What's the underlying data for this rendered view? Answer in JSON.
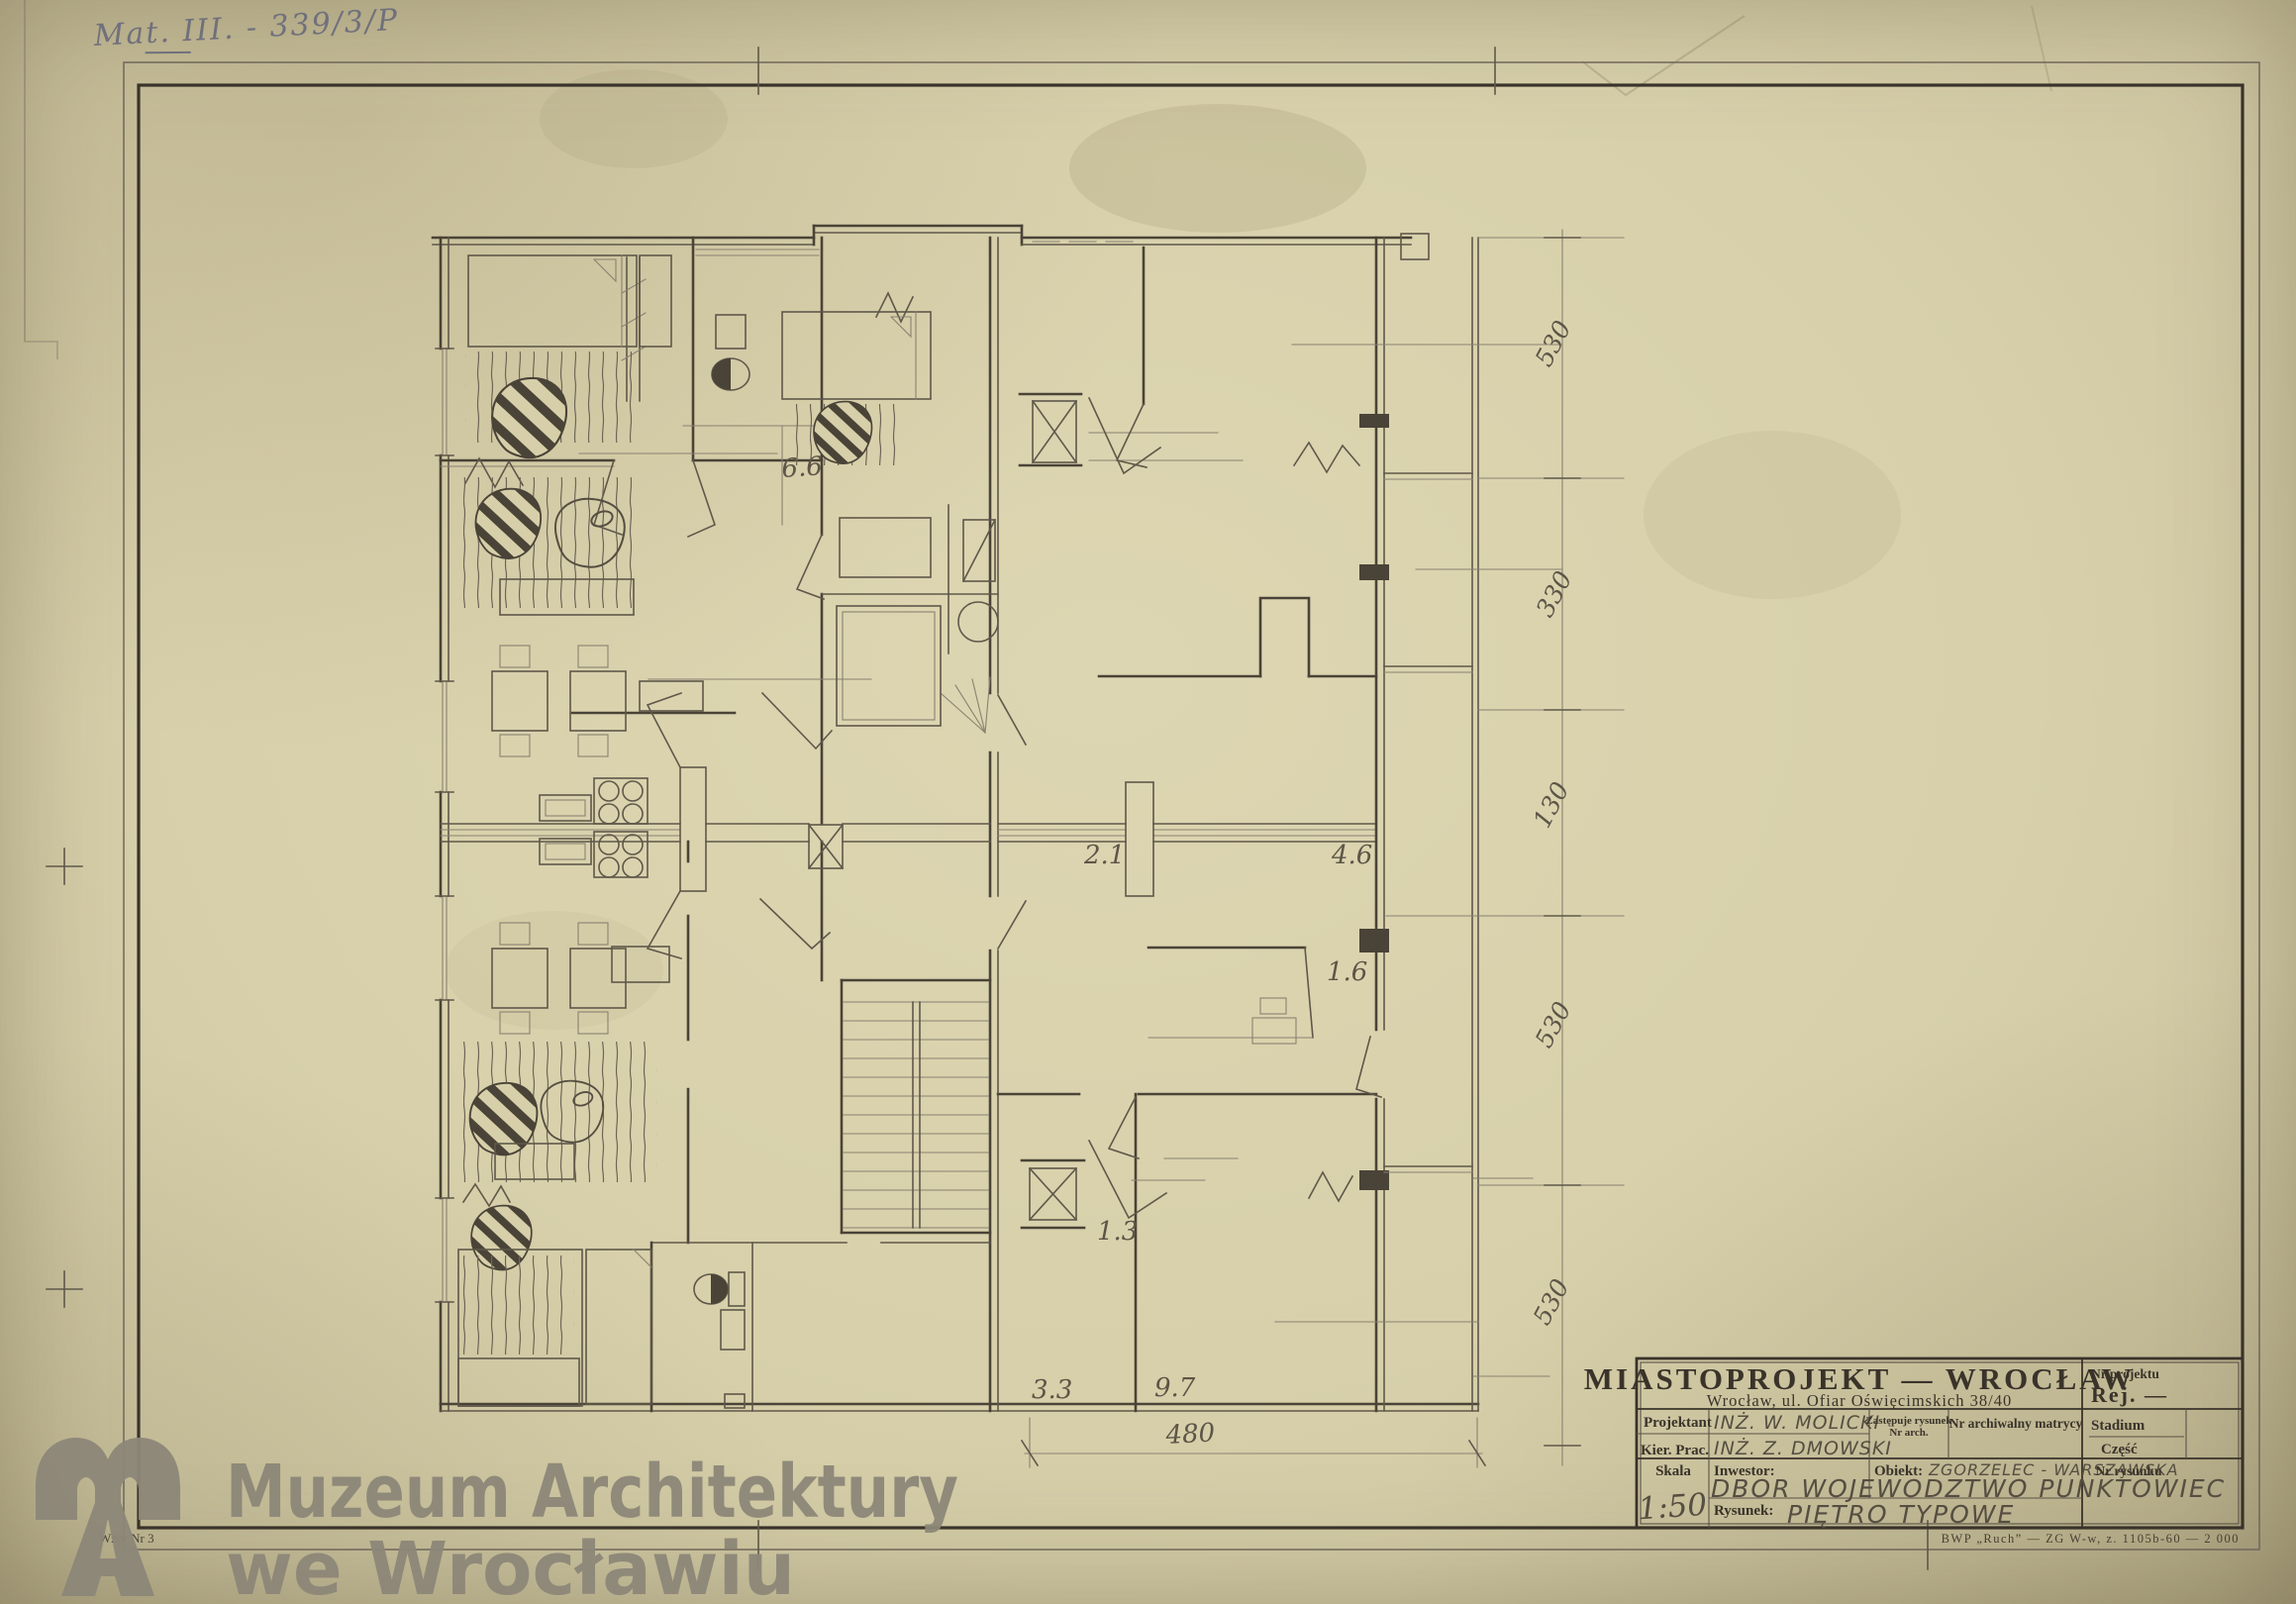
{
  "colors": {
    "paper": "#d7d0aa",
    "pencil": "#5f584a",
    "heavy_line": "#3a332a",
    "watermark_gray": "#8d8779",
    "annotation_pencil": "#70707c"
  },
  "archive_annotation": "Mat. III. - 339/3/P",
  "form_note": "Wzór Nr 3",
  "print_credit": "BWP „Ruch” — ZG W-w, z. 1105b-60 — 2 000",
  "watermark": {
    "logo": "MA monogram",
    "line1": "Muzeum Architektury",
    "line2": "we Wrocławiu"
  },
  "title_block": {
    "company": "MIASTOPROJEKT — WROCŁAW",
    "address": "Wrocław, ul. Ofiar Oświęcimskich 38/40",
    "projektant_label": "Projektant",
    "projektant_value": "INŻ. W. MOLICKI",
    "kier_label": "Kier. Prac.",
    "kier_value": "INŻ. Z. DMOWSKI",
    "zastepuje_line1": "Zastępuje rysunek",
    "zastepuje_line2": "Nr arch.",
    "nr_arch_label": "Nr archiwalny matrycy",
    "skala_label": "Skala",
    "skala_value": "1:50",
    "inwestor_label": "Inwestor:",
    "inwestor_value": "DBOR WOJEWODZTWO PUNKTOWIEC",
    "obiekt_label": "Obiekt:",
    "obiekt_value": "ZGORZELEC - WARSZAWSKA",
    "rysunek_label": "Rysunek:",
    "rysunek_value": "PIĘTRO TYPOWE",
    "nr_projektu_label": "Nr projektu",
    "nr_projektu_value": "Rej. —",
    "stadium_label": "Stadium",
    "czesc_label": "Część",
    "nr_rysunku_label": "Nr rysunku"
  },
  "plan": {
    "room_labels": [
      "6.6",
      "2.1",
      "4.6",
      "1.6",
      "1.3",
      "3.3",
      "9.7"
    ],
    "dimensions_right": [
      "530",
      "330",
      "130",
      "530",
      "530"
    ],
    "dimension_bottom": "480"
  }
}
